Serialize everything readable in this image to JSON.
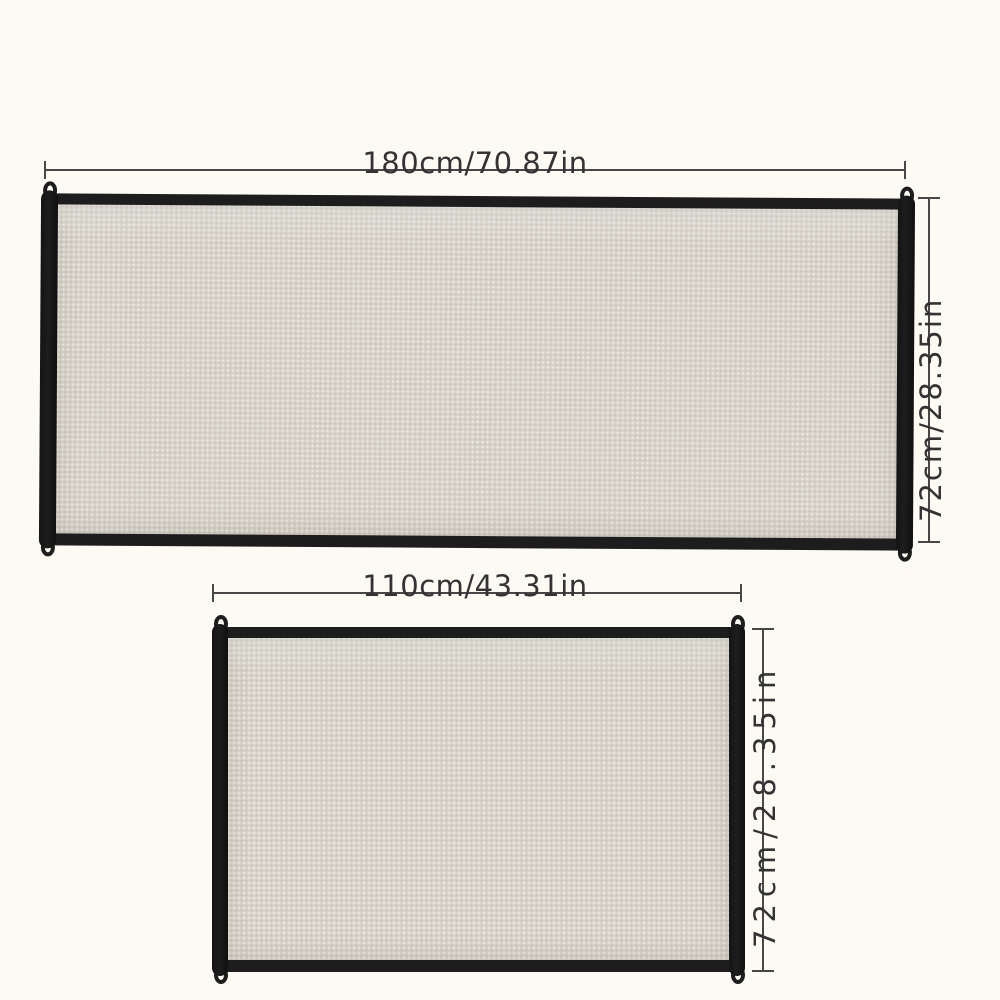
{
  "image": {
    "description": "Mesh safety gate product size diagram with two size variants"
  },
  "colors": {
    "background_color": "#fcfaf3",
    "frame_black": "#1d1d1d",
    "mesh_fill": "#d8d4cb",
    "mesh_dot_dark": "#c7c2b6",
    "mesh_dot_light": "#efede7",
    "dimension_line": "#474747",
    "label_text": "#333333"
  },
  "gates": [
    {
      "id": "large",
      "width_label": "180cm/70.87in",
      "height_label": "72cm/28.35in"
    },
    {
      "id": "small",
      "width_label": "110cm/43.31in",
      "height_label": "72cm/28.35in"
    }
  ]
}
